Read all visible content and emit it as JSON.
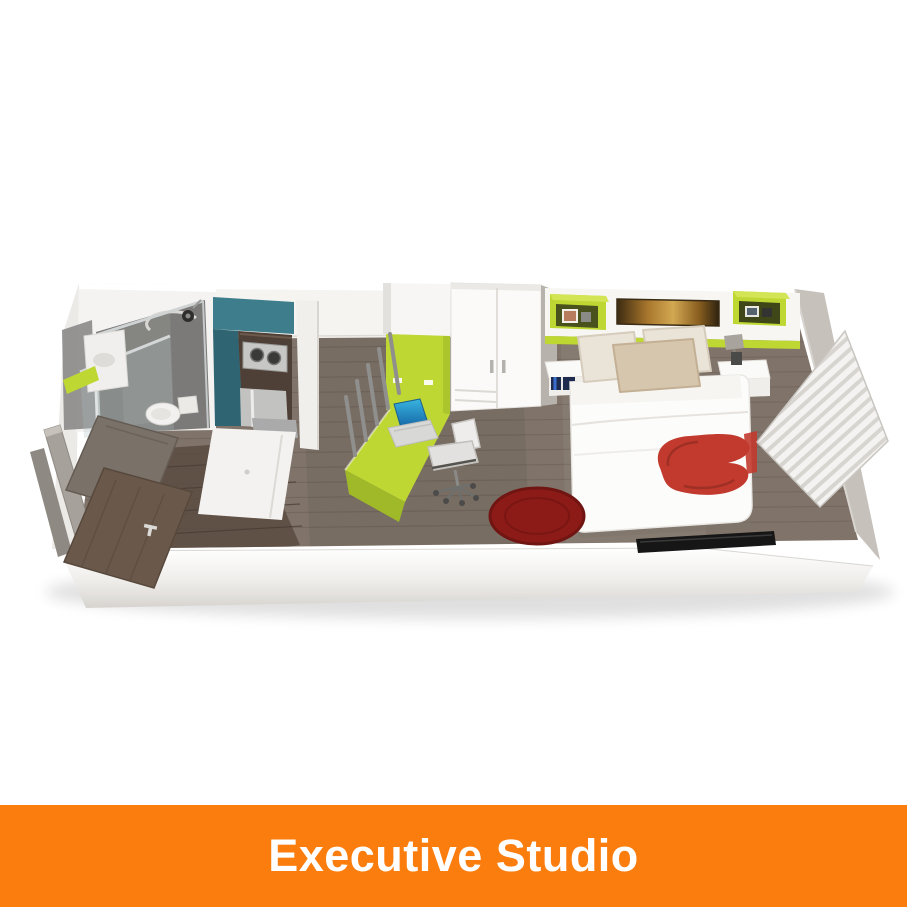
{
  "banner": {
    "label": "Executive Studio"
  },
  "colors": {
    "page_bg": "#FFFFFF",
    "banner_orange": "#FA7D0E",
    "banner_text": "#FFFFFF",
    "lime": "#BFD733",
    "lime_dark": "#9FB929",
    "lime_light": "#D3E455",
    "teal": "#3E7D8C",
    "teal_dark": "#2F6573",
    "wood": "#80746A",
    "wood_dark": "#665B51",
    "counter_wood": "#4E4036",
    "steel": "#C2C2C1",
    "rug_red": "#8C1B17",
    "throw_red": "#C23A2D",
    "door_brown": "#6A594B",
    "wall_gray": "#C6C1BA"
  },
  "floorplan": {
    "style": "3d-isometric-cutaway-render",
    "rooms": [
      "entry",
      "bathroom",
      "kitchen",
      "study-area",
      "bedroom-area"
    ],
    "items": [
      "entry-door",
      "shower",
      "toilet",
      "vanity",
      "towel",
      "kitchen-hob",
      "kitchen-counter",
      "fridge",
      "desk",
      "desk-rack",
      "laptop",
      "desk-chair",
      "wardrobe",
      "headboard-shelf",
      "wall-artwork",
      "bedside-table-left",
      "bedside-table-right",
      "table-lamp",
      "double-bed",
      "pillows",
      "red-throw",
      "red-rug",
      "tv",
      "window-blinds"
    ]
  }
}
